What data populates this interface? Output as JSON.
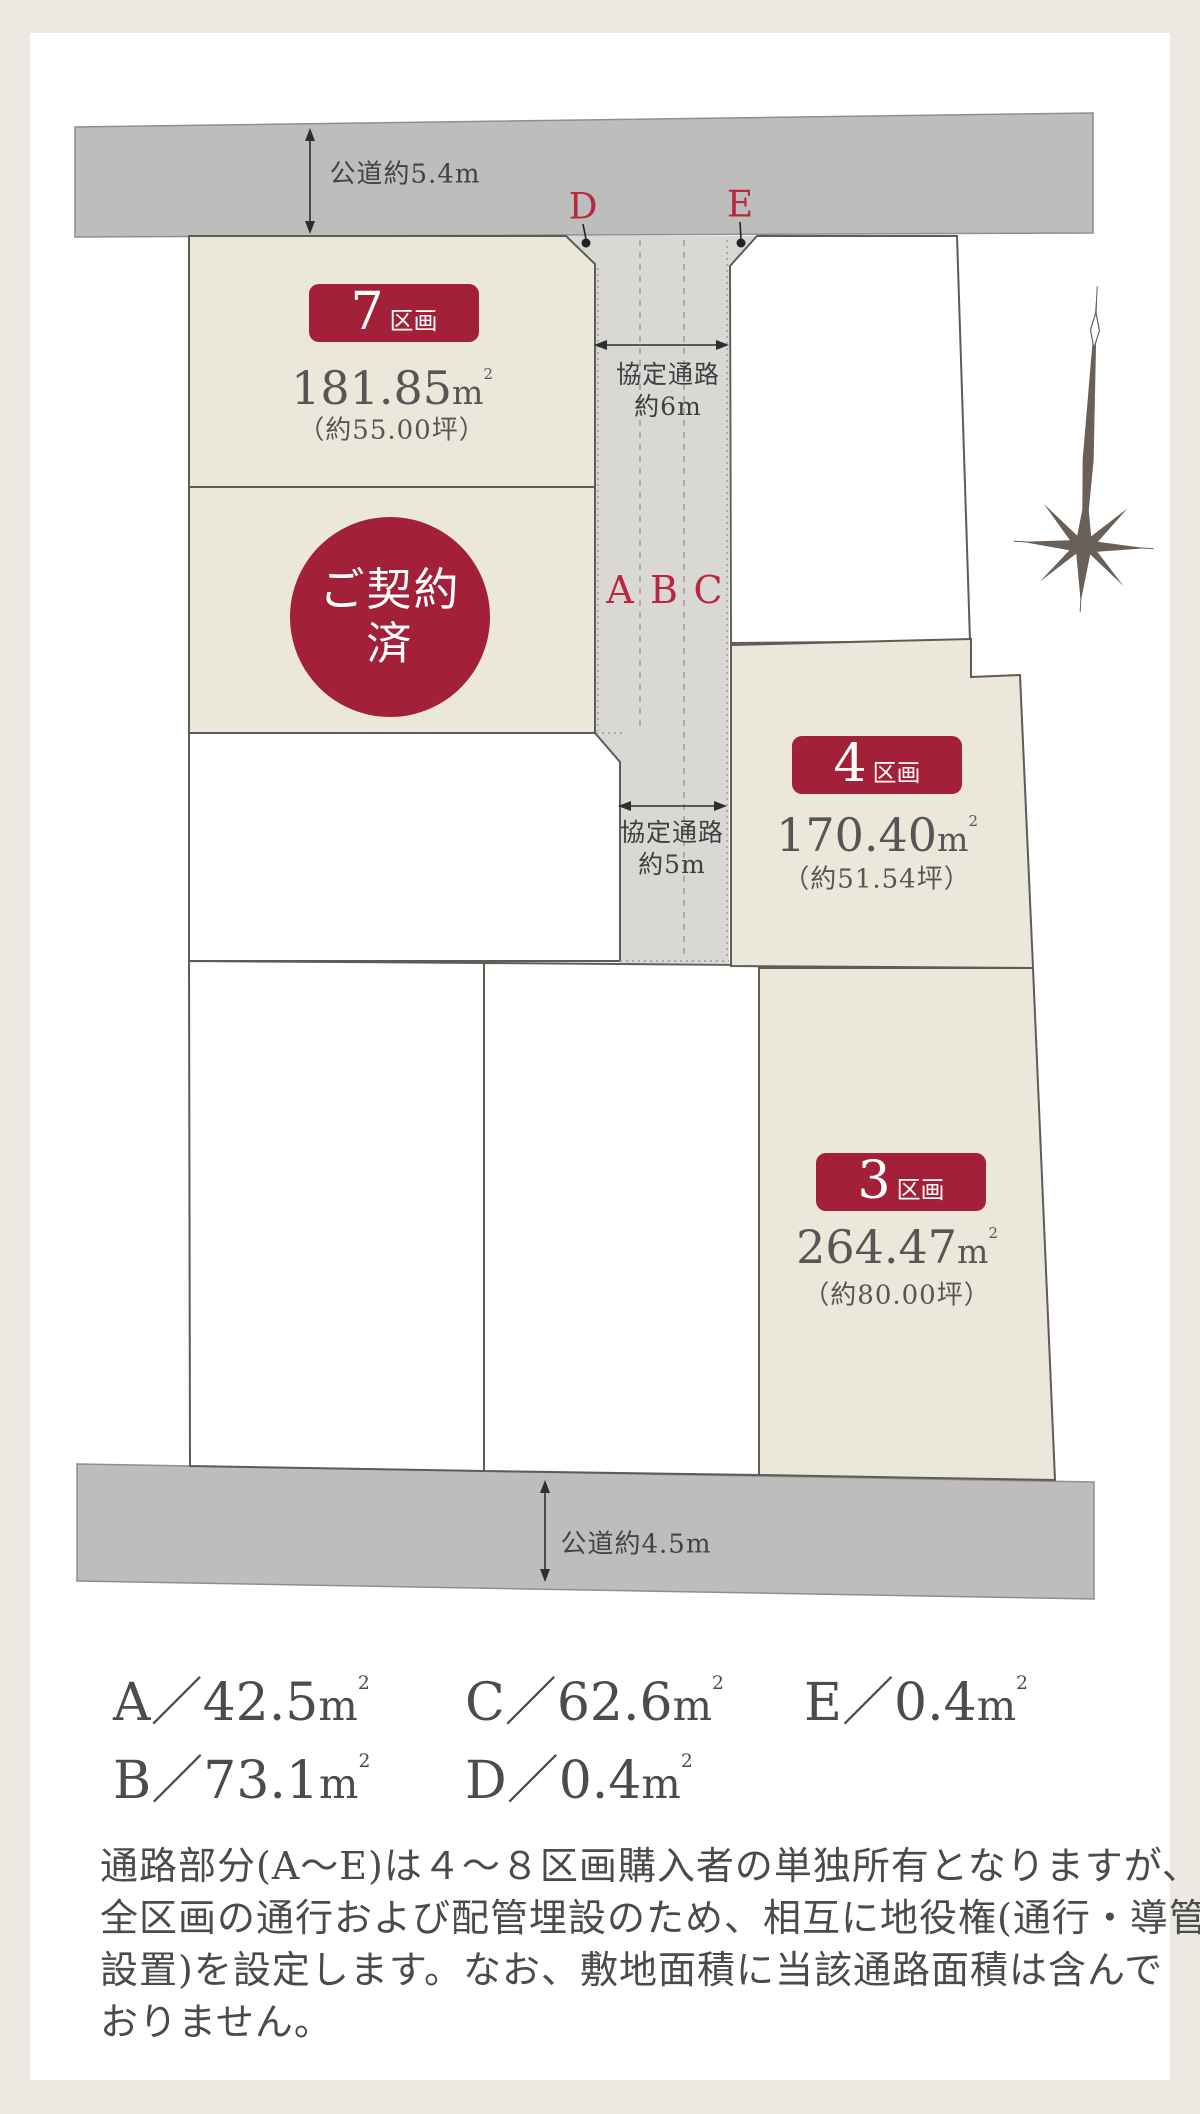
{
  "roads": {
    "top_label": "公道約5.4m",
    "bottom_label": "公道約4.5m"
  },
  "passages": {
    "six": {
      "line1": "協定通路",
      "line2": "約6m"
    },
    "five": {
      "line1": "協定通路",
      "line2": "約5m"
    }
  },
  "plots": {
    "p7": {
      "badge_number": "7",
      "badge_suffix": "区画",
      "area_value": "181.85",
      "tsubo": "（約55.00坪）",
      "status_line1": "ご契約",
      "status_line2": "済"
    },
    "p4": {
      "badge_number": "4",
      "badge_suffix": "区画",
      "area_value": "170.40",
      "tsubo": "（約51.54坪）"
    },
    "p3": {
      "badge_number": "3",
      "badge_suffix": "区画",
      "area_value": "264.47",
      "tsubo": "（約80.00坪）"
    }
  },
  "markers": {
    "a": "A",
    "b": "B",
    "c": "C",
    "d": "D",
    "e": "E"
  },
  "units": {
    "meter": "m",
    "sup": "2"
  },
  "legend": {
    "separator": "／",
    "items": [
      {
        "key": "A",
        "value": "42.5"
      },
      {
        "key": "B",
        "value": "73.1"
      },
      {
        "key": "C",
        "value": "62.6"
      },
      {
        "key": "D",
        "value": "0.4"
      },
      {
        "key": "E",
        "value": "0.4"
      }
    ]
  },
  "note": {
    "lines": [
      "通路部分(A〜E)は４〜８区画購入者の単独所有となりますが、",
      "全区画の通行および配管埋設のため、相互に地役権(通行・導管",
      "設置)を設定します。なお、敷地面積に当該通路面積は含んで",
      "おりません。"
    ]
  },
  "icons": {
    "compass": "compass-rose"
  },
  "colors": {
    "background": "#ebe9e2",
    "panel": "#ffffff",
    "road": "#bdbdbd",
    "passage": "#d9d8d5",
    "lot_beige": "#ece7db",
    "accent_red": "#a32138",
    "marker_red": "#b8273f",
    "text": "#4c4c4c"
  }
}
